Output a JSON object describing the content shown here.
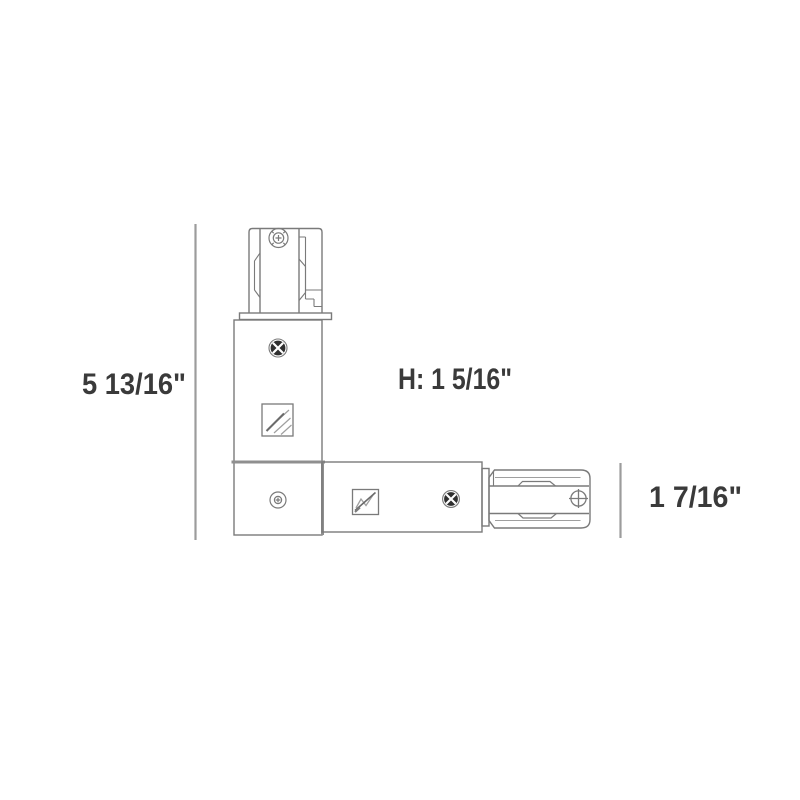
{
  "diagram": {
    "labels": {
      "height": "5 13/16\"",
      "depth": "H: 1 5/16\"",
      "width": "1 7/16\""
    },
    "colors": {
      "background": "#ffffff",
      "outline": "#7a7a7a",
      "detail": "#9f9f9f",
      "thick_line": "#8f8f8f",
      "dimension_line": "#9c9c9c",
      "text": "#3a3a3a",
      "screw_dark": "#2f2f2f",
      "screw_highlight": "#ffffff"
    },
    "icons": {
      "top_screw": "phillips-screw-icon",
      "body_screw": "phillips-screw-icon",
      "corner_screw": "phillips-screw-icon",
      "arm_screw": "phillips-screw-icon",
      "end_screw": "phillips-screw-icon",
      "body_label": "product-label-icon",
      "arm_label": "product-label-icon"
    }
  }
}
